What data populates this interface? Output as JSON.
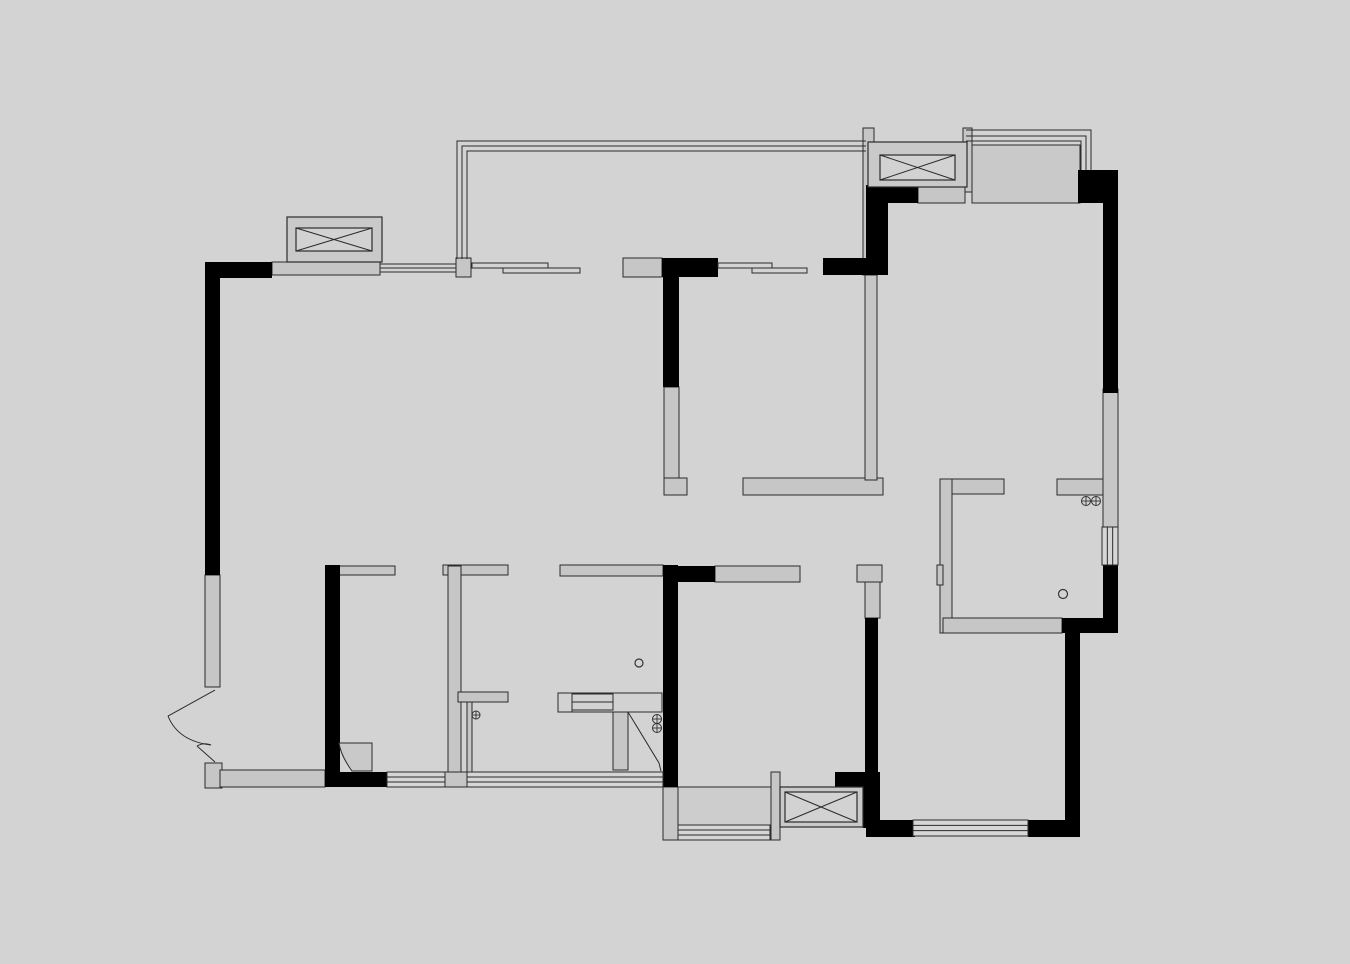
{
  "canvas": {
    "width": 1350,
    "height": 964,
    "background": "#d3d3d3"
  },
  "palette": {
    "structural_wall": "#000000",
    "partition_wall": "#c6c6c6",
    "window_box_outer": "#c9c9c9",
    "window_box_inner": "#d2d2d2",
    "platform_fill": "#c9c9c9",
    "balcony_floor": "#cdcdcd",
    "outline": "#2b2b2b"
  },
  "walls": {
    "black_rects": [
      [
        205,
        262,
        67,
        16
      ],
      [
        205,
        262,
        15,
        313
      ],
      [
        662,
        258,
        56,
        19
      ],
      [
        663,
        277,
        16,
        110
      ],
      [
        823,
        258,
        65,
        17
      ],
      [
        866,
        185,
        22,
        90
      ],
      [
        888,
        187,
        30,
        16
      ],
      [
        1078,
        170,
        40,
        33
      ],
      [
        1103,
        203,
        15,
        190
      ],
      [
        1103,
        565,
        15,
        53
      ],
      [
        1062,
        618,
        56,
        15
      ],
      [
        1065,
        633,
        15,
        204
      ],
      [
        1028,
        820,
        52,
        17
      ],
      [
        866,
        820,
        49,
        17
      ],
      [
        865,
        618,
        13,
        202
      ],
      [
        663,
        565,
        15,
        222
      ],
      [
        663,
        566,
        52,
        16
      ],
      [
        325,
        565,
        15,
        215
      ],
      [
        325,
        772,
        62,
        15
      ],
      [
        835,
        772,
        45,
        15
      ],
      [
        863,
        787,
        17,
        41
      ]
    ],
    "gray_rects": [
      [
        272,
        262,
        108,
        13
      ],
      [
        456,
        258,
        15,
        19
      ],
      [
        623,
        258,
        39,
        19
      ],
      [
        863,
        128,
        11,
        147
      ],
      [
        963,
        128,
        9,
        64
      ],
      [
        918,
        187,
        47,
        16
      ],
      [
        664,
        387,
        15,
        92
      ],
      [
        664,
        478,
        23,
        17
      ],
      [
        743,
        478,
        140,
        17
      ],
      [
        865,
        275,
        12,
        205
      ],
      [
        857,
        565,
        25,
        17
      ],
      [
        865,
        582,
        15,
        36
      ],
      [
        940,
        479,
        64,
        15
      ],
      [
        1057,
        479,
        46,
        16
      ],
      [
        940,
        479,
        12,
        154
      ],
      [
        943,
        618,
        119,
        15
      ],
      [
        937,
        565,
        6,
        20
      ],
      [
        715,
        566,
        85,
        16
      ],
      [
        560,
        565,
        103,
        11
      ],
      [
        338,
        566,
        57,
        9
      ],
      [
        443,
        565,
        65,
        10
      ],
      [
        448,
        566,
        13,
        219
      ],
      [
        445,
        772,
        22,
        15
      ],
      [
        458,
        692,
        50,
        10
      ],
      [
        205,
        575,
        15,
        112
      ],
      [
        205,
        763,
        17,
        25
      ],
      [
        220,
        770,
        105,
        17
      ],
      [
        663,
        787,
        15,
        53
      ],
      [
        1103,
        389,
        15,
        138
      ],
      [
        613,
        712,
        15,
        58
      ],
      [
        467,
        702,
        5,
        75
      ],
      [
        771,
        772,
        9,
        68
      ]
    ]
  },
  "area_fills": [
    {
      "name": "utility-platform",
      "rect": [
        972,
        145,
        108,
        58
      ],
      "color": "#c9c9c9"
    },
    {
      "name": "laundry-balcony-floor",
      "rect": [
        678,
        787,
        93,
        38
      ],
      "color": "#cdcdcd"
    }
  ],
  "x_windows": [
    {
      "name": "window-box-top-left",
      "outer": [
        287,
        217,
        95,
        45
      ],
      "inner": [
        296,
        228,
        76,
        23
      ]
    },
    {
      "name": "window-box-top-right",
      "outer": [
        868,
        142,
        99,
        45
      ],
      "inner": [
        880,
        155,
        75,
        25
      ]
    },
    {
      "name": "window-box-bottom",
      "outer": [
        780,
        787,
        83,
        40
      ],
      "inner": [
        785,
        792,
        72,
        30
      ]
    }
  ],
  "line_windows": [
    {
      "name": "window-bottom-1",
      "rect": [
        387,
        772,
        58,
        15
      ],
      "orient": "h"
    },
    {
      "name": "window-bottom-2",
      "rect": [
        467,
        772,
        196,
        15
      ],
      "orient": "h"
    },
    {
      "name": "window-balcony",
      "rect": [
        678,
        825,
        92,
        15
      ],
      "orient": "h"
    },
    {
      "name": "window-bedroom3",
      "rect": [
        913,
        820,
        115,
        16
      ],
      "orient": "h"
    },
    {
      "name": "window-right",
      "rect": [
        1102,
        527,
        16,
        38
      ],
      "orient": "v"
    }
  ],
  "railings": [
    "M866,141 H457 V259",
    "M866,146 H462 V259",
    "M866,151 H467 V259",
    "M456,264 H380",
    "M456,268 H380",
    "M456,272 H380",
    "M966,130 H1091 V170",
    "M966,136 H1086 V170",
    "M966,141 H1081 V170"
  ],
  "sliding_panels": [
    [
      472,
      263,
      76,
      5
    ],
    [
      503,
      268,
      77,
      5
    ],
    [
      718,
      263,
      54,
      5
    ],
    [
      752,
      268,
      55,
      5
    ]
  ],
  "doors": {
    "strokes": [
      {
        "d": "M215,690 L168,716",
        "w": 2.2
      },
      {
        "d": "M168,716 Q178,741 211,745",
        "w": 1
      },
      {
        "d": "M215,762 L197,746",
        "w": 2
      },
      {
        "d": "M197,746 Q204,742 211,745",
        "w": 1
      },
      {
        "d": "M628,712 L659,763 L661,771",
        "w": 1.2
      }
    ],
    "shades": [
      {
        "d": "M339,743 L372,743 L372,771 L352,771 Q341,756 339,743 Z"
      }
    ]
  },
  "fixtures": {
    "outline_rects": [
      [
        558,
        693,
        104,
        19
      ],
      [
        558,
        693,
        14,
        19
      ],
      [
        572,
        694,
        41,
        16
      ]
    ],
    "lines": [
      [
        572,
        702,
        613,
        702
      ]
    ]
  },
  "symbols": {
    "crossed_circles": [
      [
        476,
        715,
        4
      ],
      [
        657,
        719,
        4.5
      ],
      [
        657,
        728,
        4.5
      ],
      [
        1086,
        501,
        4.5
      ],
      [
        1096,
        501,
        4.5
      ]
    ],
    "circles": [
      [
        639,
        663,
        4
      ],
      [
        1063,
        594,
        4.5
      ]
    ]
  }
}
